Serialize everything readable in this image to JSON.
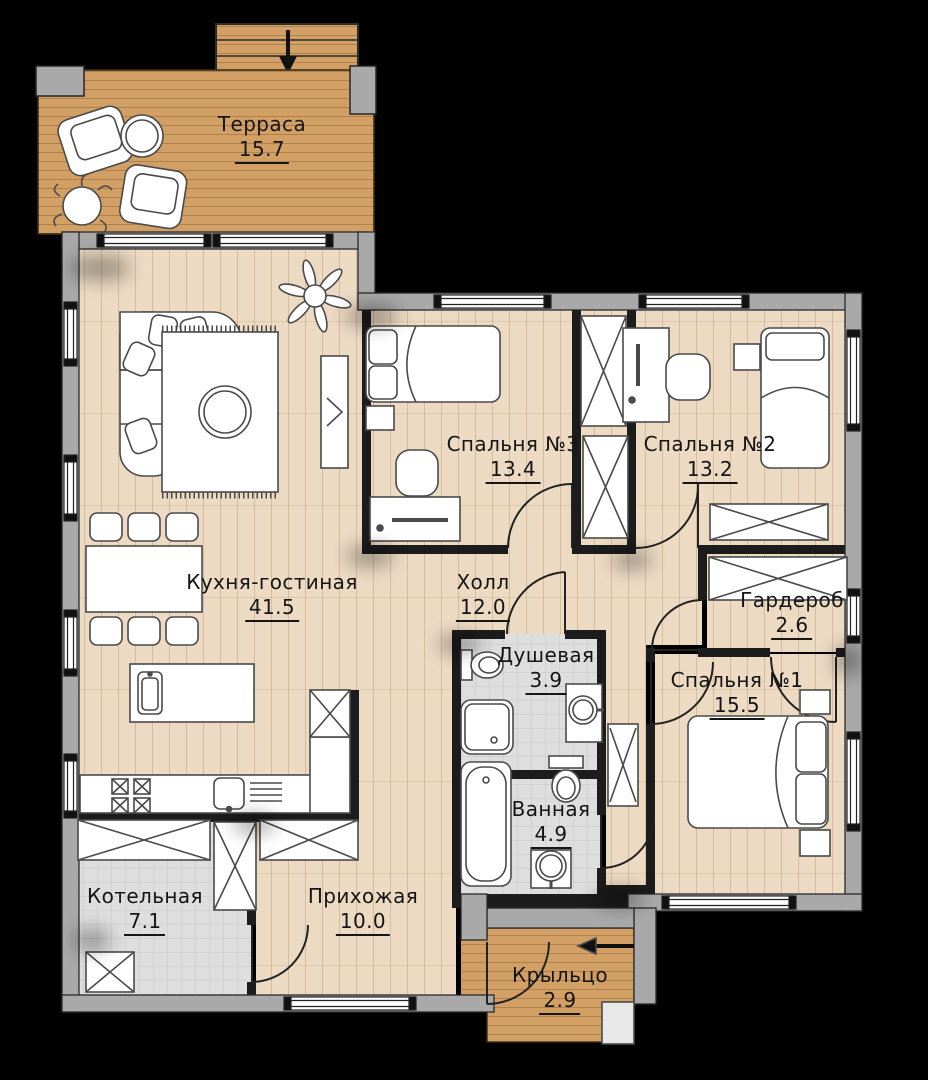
{
  "floor_plan": {
    "rooms": [
      {
        "id": "terrace",
        "name": "Терраса",
        "area": "15.7"
      },
      {
        "id": "kitchen-living",
        "name": "Кухня-гостиная",
        "area": "41.5"
      },
      {
        "id": "bedroom-3",
        "name": "Спальня №3",
        "area": "13.4"
      },
      {
        "id": "bedroom-2",
        "name": "Спальня №2",
        "area": "13.2"
      },
      {
        "id": "hall",
        "name": "Холл",
        "area": "12.0"
      },
      {
        "id": "wardrobe",
        "name": "Гардероб",
        "area": "2.6"
      },
      {
        "id": "shower",
        "name": "Душевая",
        "area": "3.9"
      },
      {
        "id": "bedroom-1",
        "name": "Спальня №1",
        "area": "15.5"
      },
      {
        "id": "bathroom",
        "name": "Ванная",
        "area": "4.9"
      },
      {
        "id": "boiler",
        "name": "Котельная",
        "area": "7.1"
      },
      {
        "id": "entry-hall",
        "name": "Прихожая",
        "area": "10.0"
      },
      {
        "id": "porch",
        "name": "Крыльцо",
        "area": "2.9"
      }
    ],
    "colors": {
      "background": "#000000",
      "deck_wood": "#d2a065",
      "interior_wood": "#ecdac3",
      "tile": "#dedede",
      "exterior_wall": "#a9a9a9",
      "interior_wall": "#1c1c1c",
      "furniture_fill": "#ffffff",
      "furniture_line": "#4a4a4a",
      "label_text": "#151515"
    }
  }
}
